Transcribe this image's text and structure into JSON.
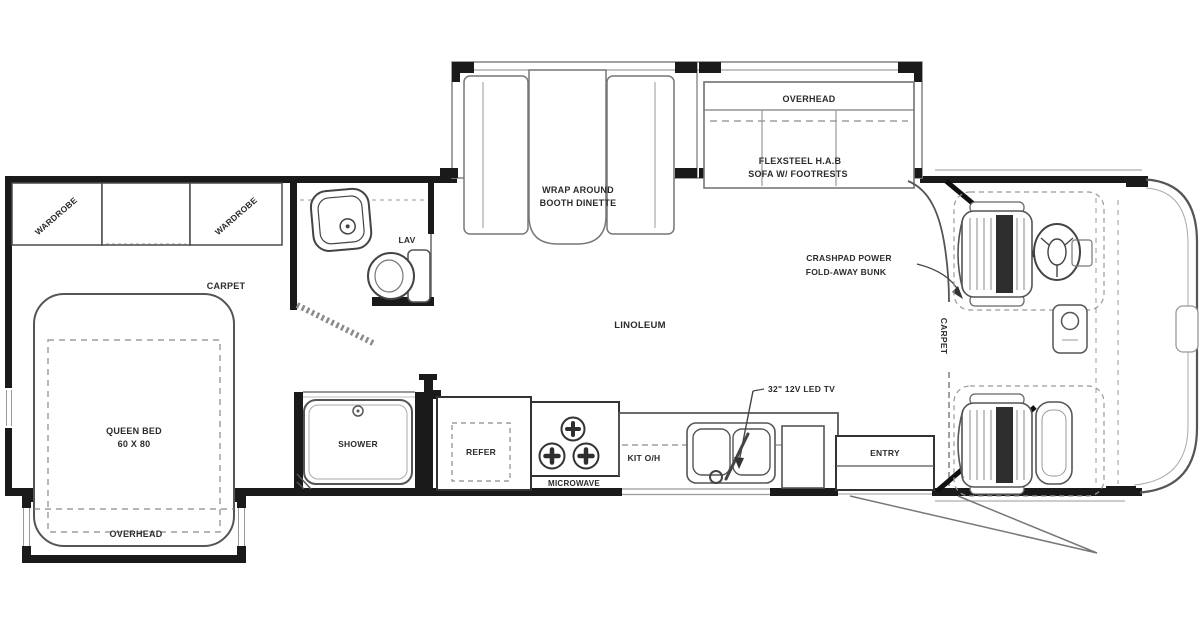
{
  "title": "Class C motorhome floor plan",
  "colors": {
    "background": "#ffffff",
    "wall": "#1a1a1a",
    "line": "#4a4a4a",
    "dash": "#8a8a8a",
    "text": "#2b2b2b"
  },
  "bedroom": {
    "wardrobe_left": "WARDROBE",
    "wardrobe_right": "WARDROBE",
    "carpet": "CARPET",
    "bed_line1": "QUEEN BED",
    "bed_line2": "60 X 80",
    "overhead": "OVERHEAD"
  },
  "bath": {
    "lav": "LAV",
    "shower": "SHOWER"
  },
  "kitchen": {
    "refer": "REFER",
    "microwave": "MICROWAVE",
    "kit_oh": "KIT O/H",
    "entry": "ENTRY"
  },
  "living": {
    "dinette_line1": "WRAP AROUND",
    "dinette_line2": "BOOTH DINETTE",
    "sofa_overhead": "OVERHEAD",
    "sofa_line1": "FLEXSTEEL H.A.B",
    "sofa_line2": "SOFA W/ FOOTRESTS",
    "linoleum": "LINOLEUM"
  },
  "cab": {
    "carpet": "CARPET",
    "bunk_line1": "CRASHPAD POWER",
    "bunk_line2": "FOLD-AWAY BUNK",
    "tv": "32\" 12V LED TV"
  }
}
